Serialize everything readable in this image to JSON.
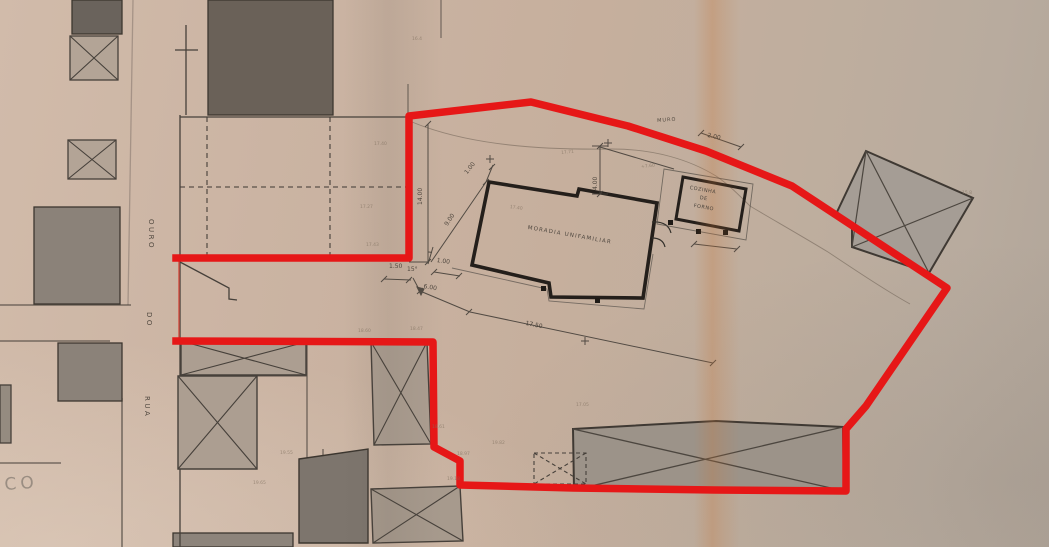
{
  "plan": {
    "type": "architectural site plan (scanned blueprint)",
    "boundary_color": "#e61717",
    "paper_color": "#c6af9d",
    "street_name": "RUA DO OURO",
    "main_building": "MORADIA UNIFAMILIAR",
    "annex_building": "COZINHA DE FORNO",
    "wall_note": "MURO",
    "corner_text": "CO",
    "dimensions": [
      "14.00",
      "9.00",
      "1.00",
      "1.00",
      "1.50",
      "15°",
      "6.00",
      "17.50",
      "4.00",
      "2.00"
    ],
    "labels": [
      {
        "id": "main-building-label",
        "t": "MORADIA UNIFAMILIAR",
        "x": 528,
        "y": 226,
        "rot": 10,
        "size": 5.5,
        "sp": 1.2,
        "cls": "ink"
      },
      {
        "id": "annex-label-cozinha",
        "t": "COZINHA",
        "x": 690,
        "y": 186,
        "rot": 10,
        "size": 5,
        "sp": 0.5,
        "cls": "ink"
      },
      {
        "id": "annex-label-de",
        "t": "DE",
        "x": 700,
        "y": 196,
        "rot": 10,
        "size": 5,
        "sp": 0.5,
        "cls": "ink"
      },
      {
        "id": "annex-label-forno",
        "t": "FORNO",
        "x": 694,
        "y": 204,
        "rot": 10,
        "size": 5,
        "sp": 0.5,
        "cls": "ink"
      },
      {
        "id": "street-name-ouro",
        "t": "OURO",
        "x": 154,
        "y": 219,
        "rot": 90,
        "size": 7,
        "sp": 2.5
      },
      {
        "id": "street-name-do",
        "t": "DO",
        "x": 152,
        "y": 312,
        "rot": 90,
        "size": 7,
        "sp": 2.5
      },
      {
        "id": "street-name-rua",
        "t": "RUA",
        "x": 150,
        "y": 396,
        "rot": 90,
        "size": 7,
        "sp": 2.5
      },
      {
        "id": "corner-text",
        "t": "CO",
        "x": 4,
        "y": 477,
        "rot": -4,
        "size": 17,
        "sp": 4,
        "cls": "faded"
      },
      {
        "id": "wall-label",
        "t": "MURO",
        "x": 657,
        "y": 119,
        "rot": -4,
        "size": 5,
        "sp": 1
      },
      {
        "id": "dim-14-00",
        "t": "14.00",
        "x": 418,
        "y": 205,
        "rot": -90,
        "size": 6
      },
      {
        "id": "dim-9-00",
        "t": "9.00",
        "x": 444,
        "y": 224,
        "rot": -56,
        "size": 6
      },
      {
        "id": "dim-1-00-upper",
        "t": "1.00",
        "x": 464,
        "y": 172,
        "rot": -52,
        "size": 6
      },
      {
        "id": "dim-1-00-lower",
        "t": "1.00",
        "x": 437,
        "y": 258,
        "rot": 8,
        "size": 6
      },
      {
        "id": "dim-angle-15",
        "t": "15°",
        "x": 407,
        "y": 267,
        "rot": 0,
        "size": 6
      },
      {
        "id": "dim-1-50",
        "t": "1.50",
        "x": 389,
        "y": 264,
        "rot": 0,
        "size": 6
      },
      {
        "id": "dim-6-00",
        "t": "6.00",
        "x": 424,
        "y": 284,
        "rot": 10,
        "size": 6
      },
      {
        "id": "dim-17-50",
        "t": "17.50",
        "x": 526,
        "y": 321,
        "rot": 11,
        "size": 6
      },
      {
        "id": "dim-4-00",
        "t": "4.00",
        "x": 593,
        "y": 190,
        "rot": -90,
        "size": 6
      },
      {
        "id": "dim-2-00",
        "t": "2.00",
        "x": 708,
        "y": 133,
        "rot": 12,
        "size": 6
      },
      {
        "id": "level-17-40",
        "t": "17.40",
        "x": 374,
        "y": 143,
        "rot": 0,
        "size": 4.5,
        "cls": "lvl"
      },
      {
        "id": "level-17-27",
        "t": "17.27",
        "x": 360,
        "y": 206,
        "rot": 0,
        "size": 4.5,
        "cls": "lvl"
      },
      {
        "id": "level-17-43",
        "t": "17.43",
        "x": 366,
        "y": 244,
        "rot": 0,
        "size": 4.5,
        "cls": "lvl"
      },
      {
        "id": "level-16-4",
        "t": "16.4",
        "x": 412,
        "y": 38,
        "rot": 0,
        "size": 4.5,
        "cls": "lvl"
      },
      {
        "id": "level-17-71",
        "t": "17.71",
        "x": 561,
        "y": 152,
        "rot": -6,
        "size": 4.5,
        "cls": "lvl"
      },
      {
        "id": "level-7-60",
        "t": "+7.60",
        "x": 641,
        "y": 166,
        "rot": -6,
        "size": 4.5,
        "cls": "lvl"
      },
      {
        "id": "level-17-40-house",
        "t": "17.40",
        "x": 510,
        "y": 206,
        "rot": 8,
        "size": 4.5,
        "cls": "lvl"
      },
      {
        "id": "level-17-05",
        "t": "17.05",
        "x": 576,
        "y": 404,
        "rot": 0,
        "size": 4.5,
        "cls": "lvl"
      },
      {
        "id": "level-18-60",
        "t": "18.60",
        "x": 358,
        "y": 330,
        "rot": 0,
        "size": 4.5,
        "cls": "lvl"
      },
      {
        "id": "level-18-47",
        "t": "18.47",
        "x": 410,
        "y": 328,
        "rot": 0,
        "size": 4.5,
        "cls": "lvl"
      },
      {
        "id": "level-18-61",
        "t": "18.61",
        "x": 432,
        "y": 426,
        "rot": 0,
        "size": 4.5,
        "cls": "lvl"
      },
      {
        "id": "level-18-97",
        "t": "18.97",
        "x": 457,
        "y": 453,
        "rot": 0,
        "size": 4.5,
        "cls": "lvl"
      },
      {
        "id": "level-19-18",
        "t": "19.18",
        "x": 447,
        "y": 478,
        "rot": 0,
        "size": 4.5,
        "cls": "lvl"
      },
      {
        "id": "level-19-82",
        "t": "19.82",
        "x": 492,
        "y": 442,
        "rot": 0,
        "size": 4.5,
        "cls": "lvl"
      },
      {
        "id": "level-19-55",
        "t": "19.55",
        "x": 280,
        "y": 452,
        "rot": 0,
        "size": 4.5,
        "cls": "lvl"
      },
      {
        "id": "level-19-65",
        "t": "19.65",
        "x": 253,
        "y": 482,
        "rot": 0,
        "size": 4.5,
        "cls": "lvl"
      },
      {
        "id": "level-15-8",
        "t": "15.8",
        "x": 962,
        "y": 192,
        "rot": 0,
        "size": 4.5,
        "cls": "lvl"
      }
    ]
  }
}
